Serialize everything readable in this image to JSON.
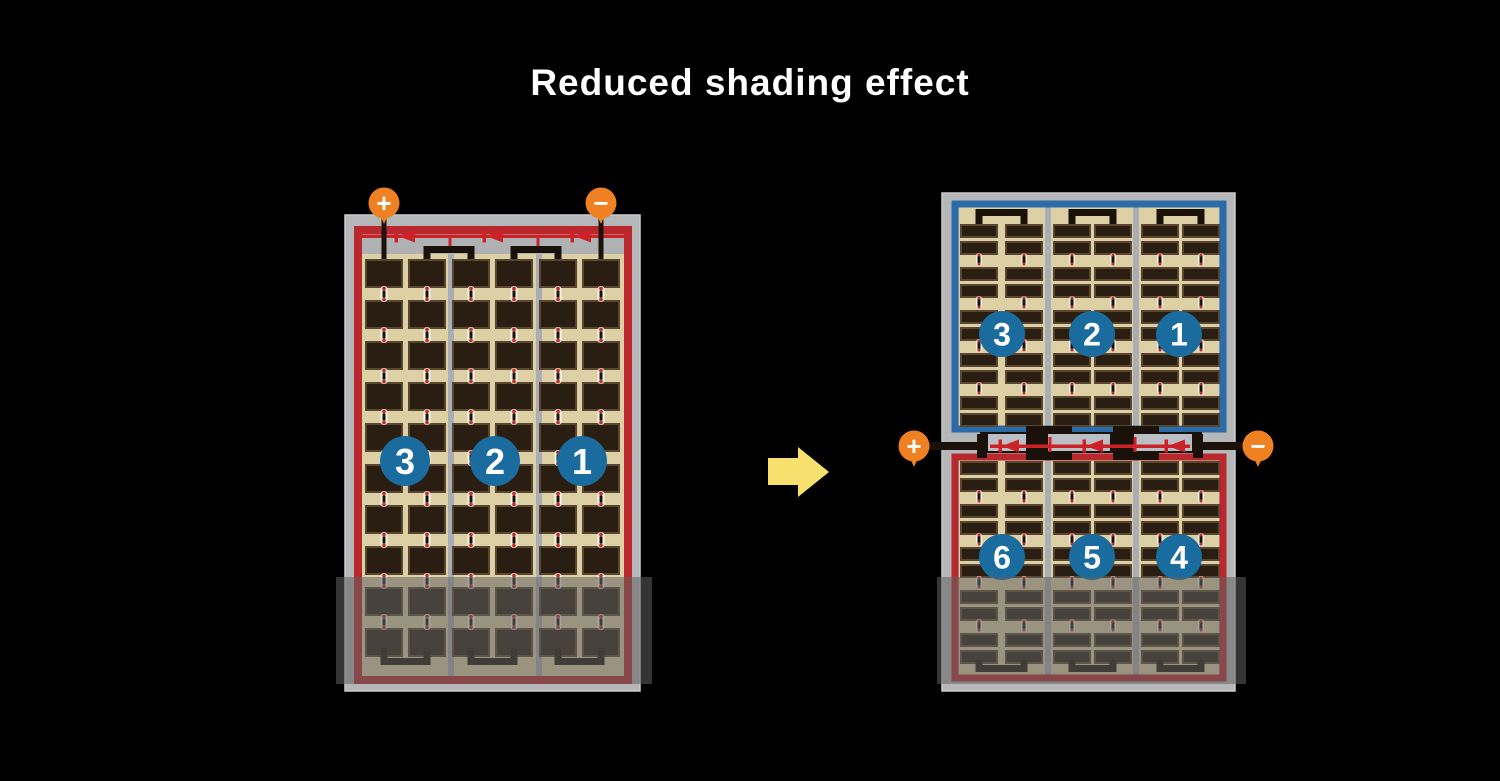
{
  "title": "Reduced shading effect",
  "terminals": {
    "plus_label": "+",
    "minus_label": "−"
  },
  "left_panel": {
    "section_numbers": [
      "3",
      "2",
      "1"
    ]
  },
  "right_panel": {
    "top_section_numbers": [
      "3",
      "2",
      "1"
    ],
    "bottom_section_numbers": [
      "6",
      "5",
      "4"
    ]
  },
  "icons": {
    "arrow": "right-arrow",
    "diode": "bypass-diode"
  },
  "colors": {
    "background": "#000000",
    "title_color": "#ffffff",
    "frame": "#b6b7b9",
    "frame_inner": "#b0b1b3",
    "cell_area": "#ddd0a4",
    "cell": "#2a1d12",
    "cell_edge": "#5a4630",
    "separator": "#a9adb5",
    "red_border": "#b8282d",
    "blue_border": "#2b6ca8",
    "circuit_red": "#cc2127",
    "terminal_orange": "#f08122",
    "number_circle": "#1a6b9e",
    "wire_black": "#1a120a",
    "connector_white": "#f7f3e8",
    "connector_red": "#c03030",
    "connector_bar": "#1a120b",
    "arrow_yellow": "#f8e06e",
    "shade": "rgba(97,97,97,0.55)"
  }
}
